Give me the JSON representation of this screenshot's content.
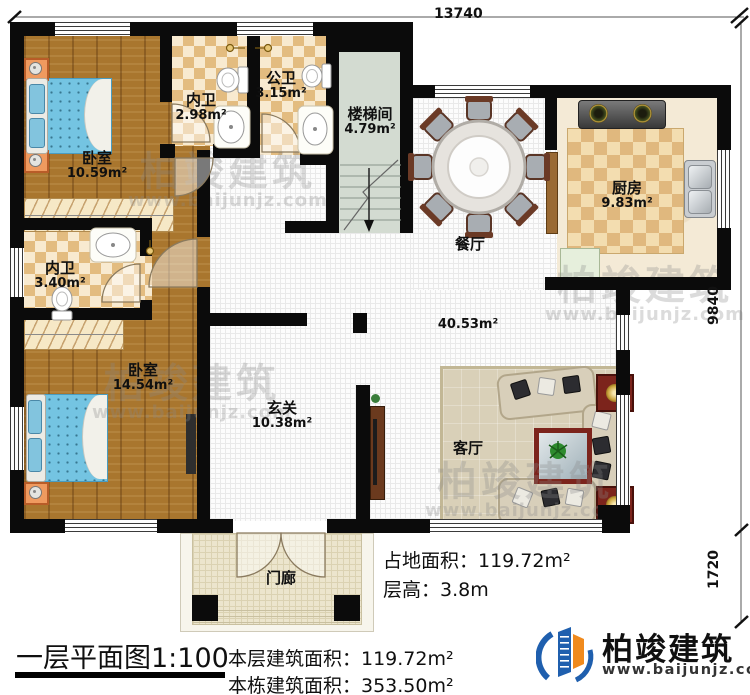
{
  "plan": {
    "dimensions": {
      "top": "13740",
      "right_main": "9840",
      "right_porch": "1720"
    },
    "rooms": [
      {
        "id": "bedroom-1",
        "name": "卧室",
        "area": "10.59m²"
      },
      {
        "id": "ensuite-1",
        "name": "内卫",
        "area": "2.98m²"
      },
      {
        "id": "public-bath",
        "name": "公卫",
        "area": "3.15m²"
      },
      {
        "id": "stairwell",
        "name": "楼梯间",
        "area": "4.79m²"
      },
      {
        "id": "kitchen",
        "name": "厨房",
        "area": "9.83m²"
      },
      {
        "id": "dining",
        "name": "餐厅",
        "area": ""
      },
      {
        "id": "ensuite-2",
        "name": "内卫",
        "area": "3.40m²"
      },
      {
        "id": "bedroom-2",
        "name": "卧室",
        "area": "14.54m²"
      },
      {
        "id": "foyer",
        "name": "玄关",
        "area": "10.38m²"
      },
      {
        "id": "living",
        "name": "客厅",
        "area": ""
      },
      {
        "id": "porch",
        "name": "门廊",
        "area": ""
      }
    ],
    "living_dining_area": "40.53m²"
  },
  "footer": {
    "title": "一层平面图1:100",
    "site_area": "占地面积：119.72m²",
    "floor_height": "层高：3.8m",
    "floor_area": "本层建筑面积：119.72m²",
    "building_area": "本栋建筑面积：353.50m²"
  },
  "brand": {
    "name": "柏竣建筑",
    "url": "www.baijunjz.com"
  },
  "watermark": {
    "name": "柏竣建筑",
    "url": "www.baijunjz.com"
  }
}
